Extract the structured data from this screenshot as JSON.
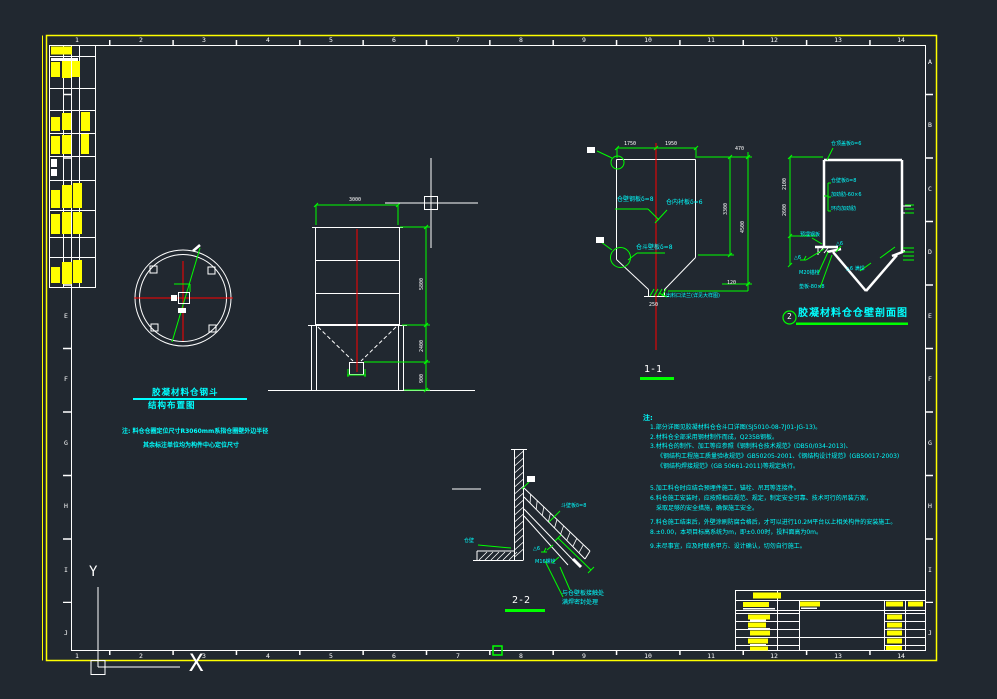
{
  "frame": {
    "columns": [
      "1",
      "2",
      "3",
      "4",
      "5",
      "6",
      "7",
      "8",
      "9",
      "10",
      "11",
      "12",
      "13",
      "14"
    ],
    "rows": [
      "A",
      "B",
      "C",
      "D",
      "E",
      "F",
      "G",
      "H",
      "I",
      "J"
    ]
  },
  "ucs": {
    "y_label": "Y",
    "x_label": "X"
  },
  "plan": {
    "title": "胶凝材料仓钢斗",
    "subtitle": "结构布置图",
    "note1": "注: 料仓仓圈定位尺寸R3060mm系指仓圈壁外边半径",
    "note2": "其余标注单位均为构件中心定位尺寸"
  },
  "elevation": {
    "dim_width": "3000",
    "dim_h1": "5800",
    "dim_h2": "2400",
    "dim_h3": "900"
  },
  "section1": {
    "title": "1-1",
    "dim_left": "1750",
    "dim_right": "1950",
    "dim_total": "470",
    "dim_side_a": "3300",
    "dim_side_b": "4500",
    "dim_bottom": "120",
    "dim_outlet": "250",
    "label_wall": "仓壁钢板δ=8",
    "label_liner": "仓内衬板δ=6",
    "label_hopper": "仓斗壁板δ=8",
    "label_outlet": "出料口法兰(详见大样图)"
  },
  "section2": {
    "bubble": "2",
    "title": "胶凝材料仓仓壁剖面图",
    "label_top": "仓顶盖板δ=6",
    "label_wall": "仓壁板δ=8",
    "label_rib": "加劲肋-60×6",
    "label_ring": "环向加劲肋",
    "label_embed": "预埋钢板",
    "label_weld1": "△6",
    "label_anchor": "M20锚栓",
    "label_pad": "垫板-80×8",
    "label_weld2": "△6 满焊",
    "label_weld3": "△6",
    "dim_a": "2100",
    "dim_b": "2600"
  },
  "detail": {
    "title": "2-2",
    "label_wall": "仓壁",
    "label_plate": "斗壁板δ=8",
    "label_weld": "△6",
    "label_bolt": "M16螺栓",
    "label_note1": "与仓壁板接触处",
    "label_note2": "满焊密封处理"
  },
  "notes": {
    "header": "注:",
    "lines": [
      "1.部分详图见胶凝材料仓仓斗口详图(SJ5010-08-7J01-JG-13)。",
      "2.材料仓全部采用钢材制作而成，Q235B钢板。",
      "3.材料仓的制作、加工等应参照《钢制料仓技术规范》(DB50/034-2013)、",
      "《钢结构工程施工质量验收规范》GB50205-2001、《钢结构设计规范》(GB50017-2003)",
      "《钢结构焊接规范》(GB 50661-2011)等规定执行。",
      "5.加工料仓时应结合预埋件施工，锚栓、吊耳等连接件。",
      "6.料仓施工安装时，应按照相应规范、规定，制定安全可靠、技术可行的吊装方案，",
      "采取足够的安全措施，确保施工安全。",
      "7.料仓施工结束后，外壁涂刷防腐合格后，才可以进行10.2M平台以上相关构件的安装施工。",
      "8.±0.00，本项目标高系统为m，即±0.00时，投料面高为0m。",
      "9.未尽事宜，应及时联系甲方、设计确认，切勿自行施工。"
    ]
  },
  "colors": {
    "background": "#212830",
    "border": "#ffff00",
    "linework": "#ffffff",
    "dimension": "#00ff00",
    "centerline": "#ff0000",
    "annotation": "#00ffff"
  }
}
